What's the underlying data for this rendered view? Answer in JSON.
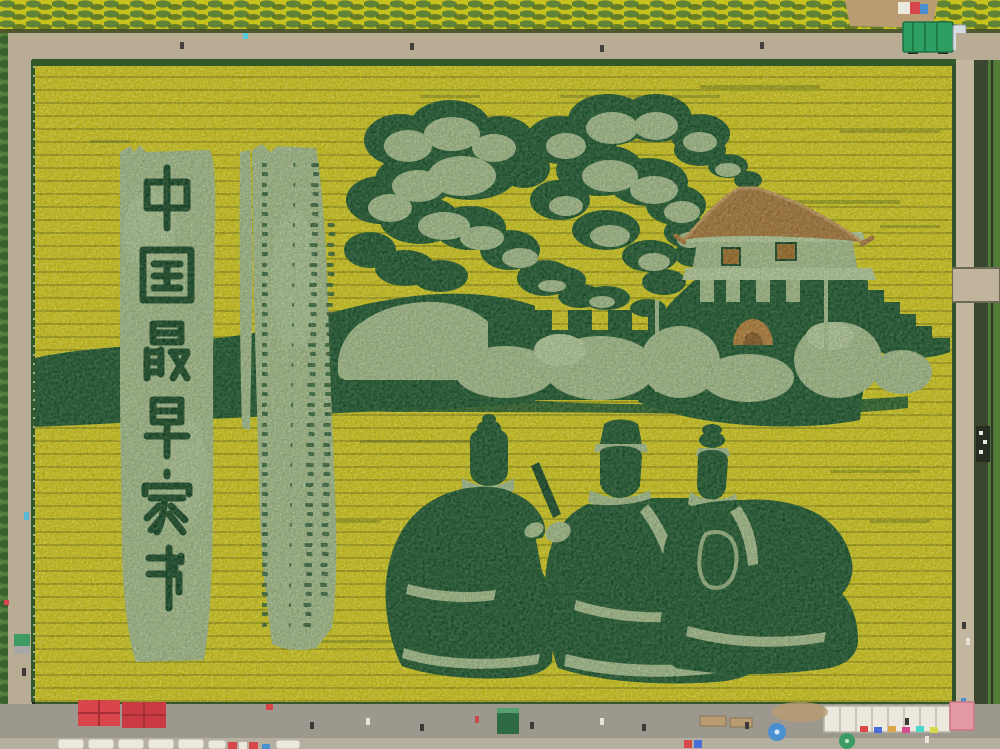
{
  "scene": {
    "alt": "Aerial view of a yellow rapeseed field with green crop art: vertical banner of Chinese characters, a wooden-slip letter tablet, beacon smoke clouds, a Great Wall beacon tower with arched gate, and three kneeling ancient figures writing a letter; roads, tents and umbrellas surround the field",
    "banner": {
      "text": "中国最早家书",
      "characters": [
        "中",
        "国",
        "最",
        "早",
        "家",
        "书"
      ]
    },
    "tablet": {
      "label": "wooden-slip letter with small illegible script"
    },
    "elements": [
      {
        "name": "smoke-cloud-left"
      },
      {
        "name": "smoke-cloud-right"
      },
      {
        "name": "great-wall"
      },
      {
        "name": "beacon-tower"
      },
      {
        "name": "gate-arch"
      },
      {
        "name": "kneeling-figure-1"
      },
      {
        "name": "kneeling-figure-2"
      },
      {
        "name": "kneeling-figure-3"
      },
      {
        "name": "writing-brush"
      },
      {
        "name": "hill-band"
      },
      {
        "name": "bush-row"
      }
    ],
    "surroundings": {
      "top_road": "dirt road with fence",
      "left_road": "dirt path",
      "right": "footpath and irrigation canal with bridge and barge",
      "bottom": "gray road with market: two red umbrellas, white canopy row, pink tent, blue umbrella, green umbrella, green booth, people",
      "truck": "green box truck on top road",
      "figure_count": 3,
      "cloud_count": 2,
      "red_umbrella_count": 2
    }
  },
  "palette": {
    "field_yellow": "#d8d021",
    "field_yellow2": "#c6c11d",
    "art_dark": "#1d5a31",
    "art_dark2": "#164a28",
    "art_light": "#a6c18f",
    "art_light2": "#b7cf9f",
    "hedge": "#547d3a",
    "hedge_dark": "#33592a",
    "road_tan": "#b9ac95",
    "road_gray": "#9d988e",
    "canal": "#3a462f",
    "roof_brown": "#a87a3c",
    "roof_ridge": "#c49a5e",
    "window_brown": "#9e702c",
    "arch_brown": "#b5823c",
    "arch_inner": "#875d26",
    "red": "#d8454a",
    "red2": "#c93a42",
    "pink": "#e598a6",
    "white": "#ece8de",
    "blue": "#4a8fd0",
    "teal": "#3d9b63",
    "truck_green": "#2f9e62",
    "dirt": "#b99c72",
    "cab": "#d5dde2"
  }
}
